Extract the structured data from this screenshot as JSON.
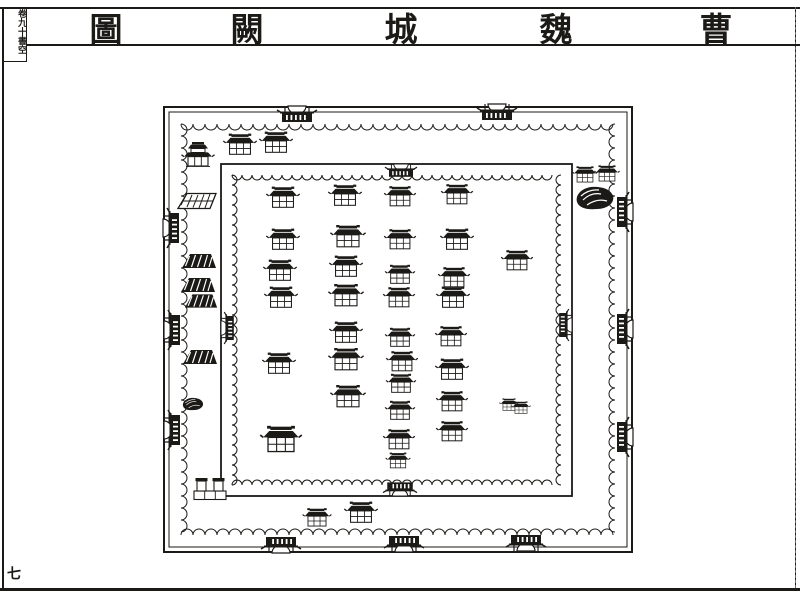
{
  "title": {
    "text": "曹魏城闕圖",
    "chars": [
      "圖",
      "闕",
      "城",
      "魏",
      "曹"
    ]
  },
  "margin_note": "卷九十書空",
  "page_number": "七",
  "colors": {
    "ink": "#1c1a17",
    "paper": "#ffffff"
  },
  "map": {
    "outer_wall": {
      "x1": 164,
      "y1": 107,
      "x2": 632,
      "y2": 552,
      "double_line_inset": 5,
      "battlement_inset": 17
    },
    "inner_wall": {
      "x1": 221,
      "y1": 164,
      "x2": 572,
      "y2": 496,
      "battlement_inset": 11
    },
    "gates": [
      {
        "wall": "outer-top",
        "x": 297,
        "y": 106,
        "s": 1
      },
      {
        "wall": "outer-top",
        "x": 497,
        "y": 104,
        "s": 1
      },
      {
        "wall": "outer-left",
        "x": 163,
        "y": 228,
        "s": 1
      },
      {
        "wall": "outer-left",
        "x": 164,
        "y": 330,
        "s": 1
      },
      {
        "wall": "outer-left",
        "x": 164,
        "y": 430,
        "s": 1
      },
      {
        "wall": "outer-right",
        "x": 633,
        "y": 212,
        "s": 1
      },
      {
        "wall": "outer-right",
        "x": 633,
        "y": 329,
        "s": 1
      },
      {
        "wall": "outer-right",
        "x": 633,
        "y": 437,
        "s": 1
      },
      {
        "wall": "outer-bottom",
        "x": 281,
        "y": 553,
        "s": 1
      },
      {
        "wall": "outer-bottom",
        "x": 404,
        "y": 552,
        "s": 1
      },
      {
        "wall": "outer-bottom",
        "x": 526,
        "y": 551,
        "s": 1
      },
      {
        "wall": "inner-top",
        "x": 401,
        "y": 164,
        "s": 0.8
      },
      {
        "wall": "inner-left",
        "x": 221,
        "y": 328,
        "s": 0.8
      },
      {
        "wall": "inner-right",
        "x": 572,
        "y": 325,
        "s": 0.8
      },
      {
        "wall": "inner-bottom",
        "x": 400,
        "y": 496,
        "s": 0.85
      }
    ],
    "structures": [
      {
        "t": "pav2",
        "x": 198,
        "y": 156,
        "s": 1
      },
      {
        "t": "hall",
        "x": 240,
        "y": 145,
        "s": 0.95
      },
      {
        "t": "hall",
        "x": 276,
        "y": 143,
        "s": 0.95
      },
      {
        "t": "terrace",
        "x": 197,
        "y": 201,
        "s": 1
      },
      {
        "t": "platform",
        "x": 199,
        "y": 261,
        "s": 1
      },
      {
        "t": "platform",
        "x": 198,
        "y": 285,
        "s": 1
      },
      {
        "t": "platform",
        "x": 201,
        "y": 301,
        "s": 0.95
      },
      {
        "t": "platform",
        "x": 200,
        "y": 357,
        "s": 1
      },
      {
        "t": "rock",
        "x": 193,
        "y": 404,
        "s": 0.55
      },
      {
        "t": "hall",
        "x": 585,
        "y": 175,
        "s": 0.72
      },
      {
        "t": "hall",
        "x": 607,
        "y": 174,
        "s": 0.72
      },
      {
        "t": "rock",
        "x": 595,
        "y": 198,
        "s": 1
      },
      {
        "t": "towers",
        "x": 210,
        "y": 489,
        "s": 1
      },
      {
        "t": "hall",
        "x": 317,
        "y": 518,
        "s": 0.82
      },
      {
        "t": "hall",
        "x": 361,
        "y": 513,
        "s": 0.95
      },
      {
        "t": "hall",
        "x": 283,
        "y": 198,
        "s": 0.95
      },
      {
        "t": "hall",
        "x": 283,
        "y": 240,
        "s": 0.95
      },
      {
        "t": "hall",
        "x": 280,
        "y": 271,
        "s": 0.95
      },
      {
        "t": "hall",
        "x": 281,
        "y": 298,
        "s": 0.95
      },
      {
        "t": "hall",
        "x": 279,
        "y": 364,
        "s": 0.95
      },
      {
        "t": "hall",
        "x": 281,
        "y": 440,
        "s": 1.18
      },
      {
        "t": "hall",
        "x": 345,
        "y": 196,
        "s": 0.95
      },
      {
        "t": "hall",
        "x": 348,
        "y": 237,
        "s": 1
      },
      {
        "t": "hall",
        "x": 346,
        "y": 267,
        "s": 0.95
      },
      {
        "t": "hall",
        "x": 346,
        "y": 296,
        "s": 1
      },
      {
        "t": "hall",
        "x": 346,
        "y": 333,
        "s": 0.95
      },
      {
        "t": "hall",
        "x": 346,
        "y": 360,
        "s": 1
      },
      {
        "t": "hall",
        "x": 348,
        "y": 397,
        "s": 1
      },
      {
        "t": "hall",
        "x": 400,
        "y": 197,
        "s": 0.9
      },
      {
        "t": "hall",
        "x": 400,
        "y": 240,
        "s": 0.9
      },
      {
        "t": "hall",
        "x": 400,
        "y": 275,
        "s": 0.85
      },
      {
        "t": "hall",
        "x": 399,
        "y": 298,
        "s": 0.9
      },
      {
        "t": "hall",
        "x": 400,
        "y": 338,
        "s": 0.85
      },
      {
        "t": "hall",
        "x": 402,
        "y": 362,
        "s": 0.9
      },
      {
        "t": "hall",
        "x": 401,
        "y": 384,
        "s": 0.85
      },
      {
        "t": "hall",
        "x": 400,
        "y": 411,
        "s": 0.85
      },
      {
        "t": "hall",
        "x": 399,
        "y": 440,
        "s": 0.9
      },
      {
        "t": "hall",
        "x": 398,
        "y": 461,
        "s": 0.7
      },
      {
        "t": "hall",
        "x": 457,
        "y": 195,
        "s": 0.9
      },
      {
        "t": "hall",
        "x": 457,
        "y": 240,
        "s": 0.95
      },
      {
        "t": "hall",
        "x": 454,
        "y": 278,
        "s": 0.9
      },
      {
        "t": "hall",
        "x": 453,
        "y": 298,
        "s": 0.95
      },
      {
        "t": "hall",
        "x": 451,
        "y": 337,
        "s": 0.9
      },
      {
        "t": "hall",
        "x": 452,
        "y": 370,
        "s": 0.95
      },
      {
        "t": "hall",
        "x": 452,
        "y": 402,
        "s": 0.9
      },
      {
        "t": "hall",
        "x": 452,
        "y": 432,
        "s": 0.9
      },
      {
        "t": "hall",
        "x": 517,
        "y": 261,
        "s": 0.9
      },
      {
        "t": "hall",
        "x": 509,
        "y": 405,
        "s": 0.55
      },
      {
        "t": "hall",
        "x": 521,
        "y": 408,
        "s": 0.55
      }
    ]
  }
}
